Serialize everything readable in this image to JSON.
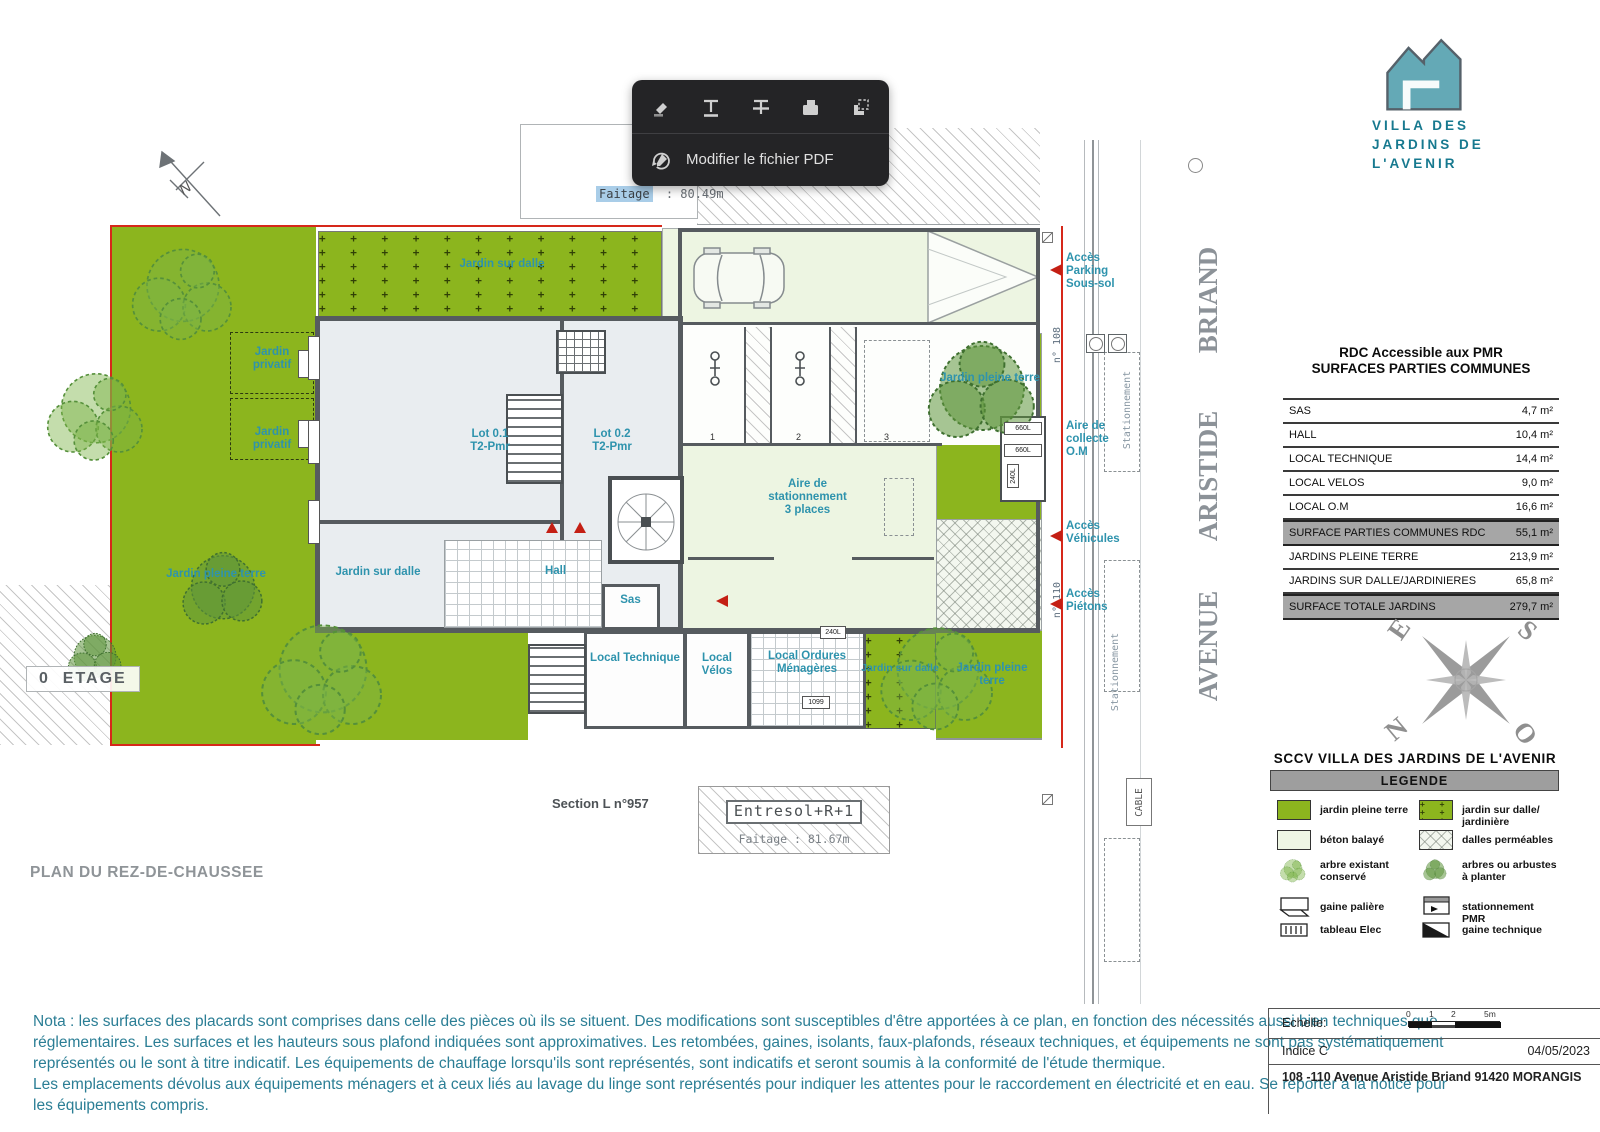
{
  "toolbar": {
    "modify_label": "Modifier le fichier PDF",
    "icons": [
      "highlighter-icon",
      "text-underline-icon",
      "text-strikethrough-icon",
      "redact-icon",
      "select-area-icon",
      "edit-pdf-icon"
    ]
  },
  "logo": {
    "line1": "VILLA DES",
    "line2": "JARDINS DE",
    "line3": "L'AVENIR"
  },
  "plan": {
    "faitage_top_label": "Faitage",
    "faitage_top_value": ": 80.49m",
    "etage_label": "0  ETAGE",
    "plan_title": "PLAN DU REZ-DE-CHAUSSEE",
    "section_label": "Section L n°957",
    "entresol_label": "Entresol+R+1",
    "entresol_faitage": "Faitage : 81.67m",
    "north_letter": "N",
    "street": {
      "word1": "AVENUE",
      "word2": "ARISTIDE",
      "word3": "BRIAND"
    },
    "labels": {
      "jardin_sur_dalle": "Jardin sur dalle",
      "jardin_pleine_terre": "Jardin pleine terre",
      "jardin_privatif": "Jardin privatif",
      "lot1": "Lot 0.1",
      "lot2": "Lot 0.2",
      "lot_type": "T2-Pmr",
      "hall": "Hall",
      "sas": "Sas",
      "aire_line1": "Aire de",
      "aire_line2": "stationnement",
      "aire_line3": "3 places",
      "local_technique": "Local Technique",
      "local_velos": "Local Vélos",
      "local_om": "Local Ordures Ménagères",
      "acces_parking": "Accès Parking Sous-sol",
      "aire_collecte": "Aire de collecte O.M",
      "acces_vehicules": "Accès Véhicules",
      "acces_pietons": "Accès Piétons",
      "n108": "n° 108",
      "n110": "n° 110",
      "stationnement": "Stationnement",
      "cable": "CABLE",
      "bin660": "660L",
      "bin240": "240L",
      "bin1099": "1099",
      "bay1": "1",
      "bay2": "2",
      "bay3": "3"
    }
  },
  "table": {
    "title1": "RDC Accessible aux PMR",
    "title2": "SURFACES PARTIES COMMUNES",
    "rows": [
      {
        "label": "SAS",
        "value": "4,7 m²"
      },
      {
        "label": "HALL",
        "value": "10,4 m²"
      },
      {
        "label": "LOCAL TECHNIQUE",
        "value": "14,4 m²"
      },
      {
        "label": "LOCAL VELOS",
        "value": "9,0 m²"
      },
      {
        "label": "LOCAL O.M",
        "value": "16,6 m²"
      },
      {
        "label": "SURFACE PARTIES COMMUNES RDC",
        "value": "55,1 m²"
      },
      {
        "label": "JARDINS PLEINE TERRE",
        "value": "213,9 m²"
      },
      {
        "label": "JARDINS SUR DALLE/JARDINIERES",
        "value": "65,8 m²"
      },
      {
        "label": "SURFACE TOTALE JARDINS",
        "value": "279,7 m²"
      }
    ]
  },
  "compass": {
    "e": "E",
    "s": "S",
    "n": "N",
    "o": "O"
  },
  "legend": {
    "title": "SCCV VILLA DES JARDINS DE L'AVENIR",
    "header": "LEGENDE",
    "items": [
      {
        "label": "jardin pleine terre",
        "icon": "green-swatch"
      },
      {
        "label": "jardin sur dalle/ jardinière",
        "icon": "green-plus-swatch"
      },
      {
        "label": "béton balayé",
        "icon": "pale-swatch"
      },
      {
        "label": "dalles perméables",
        "icon": "crosshatch-swatch"
      },
      {
        "label": "arbre existant conservé",
        "icon": "tree-light-icon"
      },
      {
        "label": "arbres ou arbustes à planter",
        "icon": "tree-dark-icon"
      },
      {
        "label": "gaine palière",
        "icon": "gaine-paliere-icon"
      },
      {
        "label": "stationnement PMR",
        "icon": "pmr-icon"
      },
      {
        "label": "tableau Elec",
        "icon": "tableau-elec-icon"
      },
      {
        "label": "gaine technique",
        "icon": "gaine-technique-icon"
      }
    ]
  },
  "notes": {
    "lines": [
      "Nota : les surfaces des placards sont comprises dans celle des pièces où ils se situent. Des modifications sont susceptibles d'être apportées à ce plan, en fonction des nécessités aussi bien techniques que",
      "réglementaires. Les surfaces et les hauteurs sous plafond indiquées sont approximatives. Les retombées, gaines, isolants, faux-plafonds, réseaux techniques, et équipements ne sont pas systématiquement",
      "représentés ou le sont à titre indicatif. Les équipements de chauffage lorsqu'ils sont représentés, sont indicatifs et seront soumis à la conformité de l'étude thermique.",
      "Les emplacements dévolus aux équipements ménagers et à ceux liés au lavage du linge sont représentés pour indiquer les attentes pour le raccordement en électricité et en eau. Se reporter à la notice pour",
      "les équipements compris."
    ]
  },
  "title_block": {
    "echelle_label": "Echelle:",
    "tick0": "0",
    "tick1": "1",
    "tick2": "2",
    "tick5": "5m",
    "indice": "Indice C",
    "date": "04/05/2023",
    "address": "108 -110 Avenue Aristide Briand 91420 MORANGIS"
  }
}
